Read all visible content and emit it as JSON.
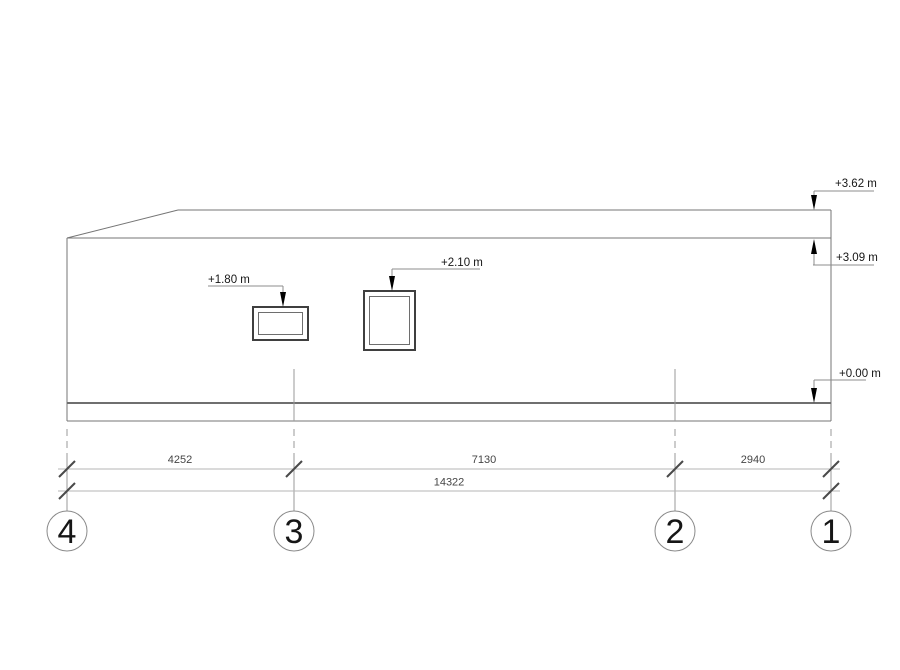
{
  "elevation_markers": {
    "roof_top": "+3.62 m",
    "eave": "+3.09 m",
    "ground": "+0.00 m",
    "window_1_head": "+1.80 m",
    "window_2_head": "+2.10 m"
  },
  "dimensions": {
    "axis_4_to_3": "4252",
    "axis_3_to_2": "7130",
    "axis_2_to_1": "2940",
    "total_4_to_1": "14322"
  },
  "grid_axes": {
    "a4": "4",
    "a3": "3",
    "a2": "2",
    "a1": "1"
  },
  "colors": {
    "background": "#ffffff",
    "outline": "#757575",
    "ground_line": "#6f6f6f",
    "window_frame_outer": "#3f3f3f",
    "window_frame_inner": "#6e6e6e",
    "leader_line": "#8c8c8c",
    "arrow": "#000000",
    "grid_line": "#9a9a9a",
    "dim_line": "#b6b6b6",
    "tick": "#4a4a4a",
    "bubble_stroke": "#8a8a8a",
    "text": "#161616",
    "dim_text": "#454545"
  }
}
